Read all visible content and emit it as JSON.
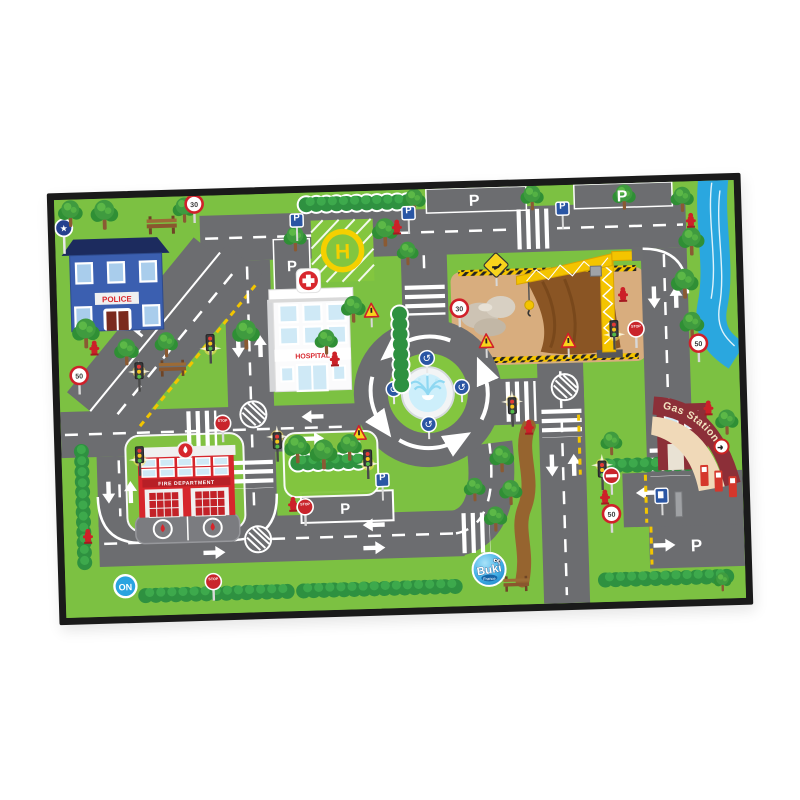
{
  "product": {
    "type": "children city road play mat",
    "brand": "Buki",
    "brand_sub": "France"
  },
  "labels": {
    "police": "POLICE",
    "hospital": "HOSPITAL",
    "helipad": "H",
    "fire_department": "FIRE DEPARTMENT",
    "gas_station": "Gas Station",
    "parking": "P",
    "stop": "STOP",
    "speed_30": "30",
    "speed_50": "50",
    "power_on": "ON",
    "police_badge": "★",
    "roundabout_sign": "↺",
    "brand": "Buki",
    "brand_sub": "France"
  },
  "colors": {
    "grass": "#7cc142",
    "island_grass": "#83c63f",
    "road": "#6c6d70",
    "marking": "#ffffff",
    "curb_yellow": "#f2c500",
    "hedge": "#2e9140",
    "river": "#2aa7df",
    "construction_sand": "#d8ad7e",
    "dirt": "#8a5524",
    "path_brown": "#96642f",
    "crane_yellow": "#f4c400",
    "sign_red": "#d0202a",
    "sign_blue": "#2a56a4",
    "police_blue": "#3b5fb0",
    "police_roof": "#1c2b5e",
    "fire_red": "#d6262c",
    "hospital_white": "#fbfbfc",
    "window_blue": "#cfe9f6",
    "gas_maroon": "#8c2f38",
    "gas_canopy": "#f0d9b8",
    "logo_blue": "#2196d9",
    "mat_border": "#1a1a1a"
  }
}
